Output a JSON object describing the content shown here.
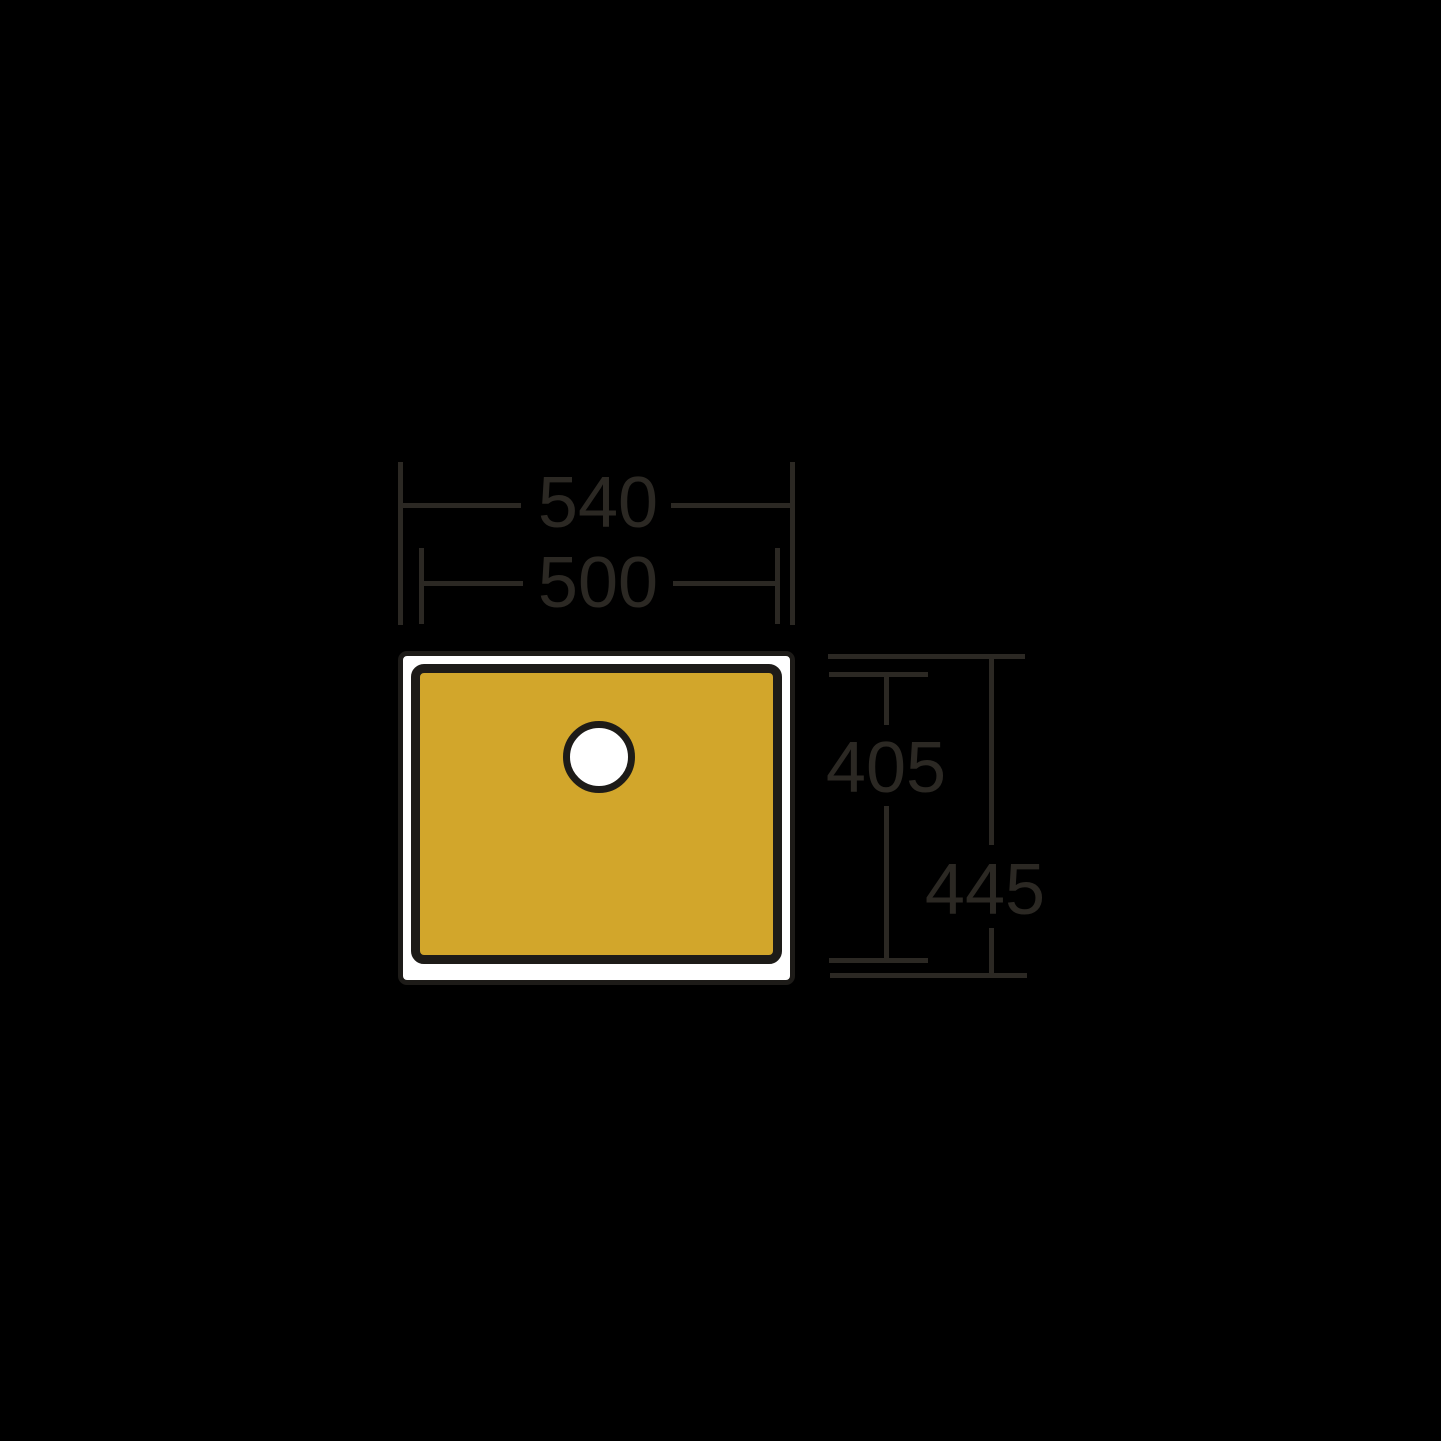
{
  "drawing": {
    "type": "technical-dimension-drawing",
    "subject": "sink-plan-view",
    "background": "#000000",
    "sink": {
      "rim_fill": "#ffffff",
      "basin_fill": "#d2a62b",
      "outline_color": "#1d1b18",
      "tap_hole_fill": "#ffffff"
    },
    "dimension_style": {
      "line_color": "#2b2823",
      "text_color": "#2b2823"
    },
    "dimensions": {
      "outer_width": "540",
      "inner_width": "500",
      "inner_depth": "405",
      "outer_depth": "445"
    }
  }
}
